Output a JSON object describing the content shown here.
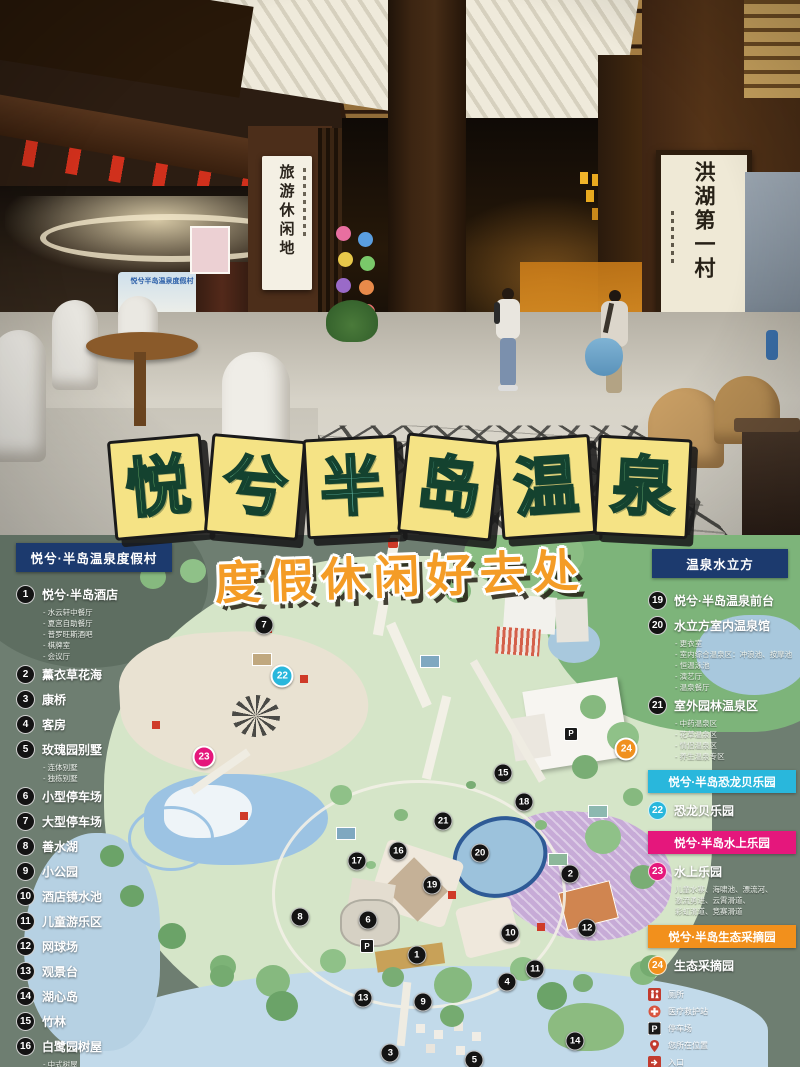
{
  "title": {
    "text": "悦兮半岛温泉",
    "tile_color": "#f5e385",
    "chars": [
      {
        "ch": "悦",
        "ink": "#8bd47a"
      },
      {
        "ch": "兮",
        "ink": "#7fd3a2"
      },
      {
        "ch": "半",
        "ink": "#74d1c0"
      },
      {
        "ch": "岛",
        "ink": "#78d2b6"
      },
      {
        "ch": "温",
        "ink": "#7dd3ad"
      },
      {
        "ch": "泉",
        "ink": "#88d38c"
      }
    ]
  },
  "subtitle": {
    "text": "度假休闲好去处",
    "color": "#f49c26"
  },
  "photo": {
    "left_scroll": "旅游休闲地",
    "right_scroll": "洪湖第一村",
    "diy_banner": {
      "header": "悦兮半岛温泉度假村",
      "title": "手工DIY"
    }
  },
  "map": {
    "p_icon": "P",
    "left_legend": {
      "header": "悦兮·半岛温泉度假村",
      "items": [
        {
          "num": "1",
          "label": "悦兮·半岛酒店",
          "subs": [
            "水云轩中餐厅",
            "夏宫自助餐厅",
            "普罗旺斯酒吧",
            "棋牌室",
            "会议厅"
          ]
        },
        {
          "num": "2",
          "label": "薰衣草花海",
          "subs": []
        },
        {
          "num": "3",
          "label": "康桥",
          "subs": []
        },
        {
          "num": "4",
          "label": "客房",
          "subs": []
        },
        {
          "num": "5",
          "label": "玫瑰园别墅",
          "subs": [
            "连体别墅",
            "独栋别墅"
          ]
        },
        {
          "num": "6",
          "label": "小型停车场",
          "subs": []
        },
        {
          "num": "7",
          "label": "大型停车场",
          "subs": []
        },
        {
          "num": "8",
          "label": "善水湖",
          "subs": []
        },
        {
          "num": "9",
          "label": "小公园",
          "subs": []
        },
        {
          "num": "10",
          "label": "酒店镜水池",
          "subs": []
        },
        {
          "num": "11",
          "label": "儿童游乐区",
          "subs": []
        },
        {
          "num": "12",
          "label": "网球场",
          "subs": []
        },
        {
          "num": "13",
          "label": "观景台",
          "subs": []
        },
        {
          "num": "14",
          "label": "湖心岛",
          "subs": []
        },
        {
          "num": "15",
          "label": "竹林",
          "subs": []
        },
        {
          "num": "16",
          "label": "白鹭园树屋",
          "subs": [
            "中式树屋",
            "日式树屋/美式树屋（在建）"
          ]
        },
        {
          "num": "17",
          "label": "码头",
          "subs": []
        }
      ]
    },
    "right_legend": {
      "header": "温泉水立方",
      "items": [
        {
          "num": "19",
          "label": "悦兮·半岛温泉前台",
          "subs": []
        },
        {
          "num": "20",
          "label": "水立方室内温泉馆",
          "subs": [
            "更衣室",
            "室内综合温泉区：冲浪池、按摩池",
            "恒温泳池",
            "演艺厅",
            "温泉餐厅"
          ]
        },
        {
          "num": "21",
          "label": "室外园林温泉区",
          "subs": [
            "中药温泉区",
            "花草温泉区",
            "情侣温泉区",
            "养生温泉专区"
          ]
        }
      ],
      "sections": [
        {
          "bar": "悦兮·半岛恐龙贝乐园",
          "color": "#29b7dc",
          "num": "22",
          "label": "恐龙贝乐园",
          "subs": []
        },
        {
          "bar": "悦兮·半岛水上乐园",
          "color": "#e5177c",
          "num": "23",
          "label": "水上乐园",
          "subs": [
            "儿童水寨、海啸池、漂流河、",
            "激流勇进、云霄滑道、",
            "彩虹滑道、竞赛滑道"
          ]
        },
        {
          "bar": "悦兮·半岛生态采摘园",
          "color": "#f2901c",
          "num": "24",
          "label": "生态采摘园",
          "subs": []
        }
      ],
      "icons": [
        {
          "icon": "restroom-icon",
          "label": "厕所"
        },
        {
          "icon": "medical-icon",
          "label": "医疗救护站"
        },
        {
          "icon": "parking-icon",
          "label": "停车场"
        },
        {
          "icon": "location-icon",
          "label": "您所在位置"
        },
        {
          "icon": "entrance-icon",
          "label": "入口"
        }
      ]
    },
    "markers": [
      {
        "n": "1",
        "x": 52.1,
        "y": 79.0
      },
      {
        "n": "2",
        "x": 71.3,
        "y": 63.7
      },
      {
        "n": "3",
        "x": 48.8,
        "y": 97.4
      },
      {
        "n": "4",
        "x": 63.4,
        "y": 84.0
      },
      {
        "n": "5",
        "x": 59.3,
        "y": 98.7
      },
      {
        "n": "6",
        "x": 46.0,
        "y": 72.4
      },
      {
        "n": "7",
        "x": 33.0,
        "y": 17.0
      },
      {
        "n": "8",
        "x": 37.5,
        "y": 71.8
      },
      {
        "n": "9",
        "x": 52.9,
        "y": 87.8
      },
      {
        "n": "10",
        "x": 63.8,
        "y": 74.8
      },
      {
        "n": "11",
        "x": 66.9,
        "y": 81.6
      },
      {
        "n": "12",
        "x": 73.4,
        "y": 73.9
      },
      {
        "n": "13",
        "x": 45.4,
        "y": 87.0
      },
      {
        "n": "14",
        "x": 71.9,
        "y": 95.1
      },
      {
        "n": "15",
        "x": 62.9,
        "y": 44.7
      },
      {
        "n": "16",
        "x": 49.8,
        "y": 59.4
      },
      {
        "n": "17",
        "x": 44.6,
        "y": 61.3
      },
      {
        "n": "18",
        "x": 65.5,
        "y": 50.2
      },
      {
        "n": "19",
        "x": 54.0,
        "y": 65.8
      },
      {
        "n": "20",
        "x": 60.0,
        "y": 59.8
      },
      {
        "n": "21",
        "x": 55.4,
        "y": 53.8
      },
      {
        "n": "22",
        "x": 35.3,
        "y": 26.5,
        "c": "#29b7dc"
      },
      {
        "n": "23",
        "x": 25.5,
        "y": 41.7,
        "c": "#e5177c"
      },
      {
        "n": "24",
        "x": 78.3,
        "y": 40.2,
        "c": "#f0901e"
      }
    ]
  }
}
